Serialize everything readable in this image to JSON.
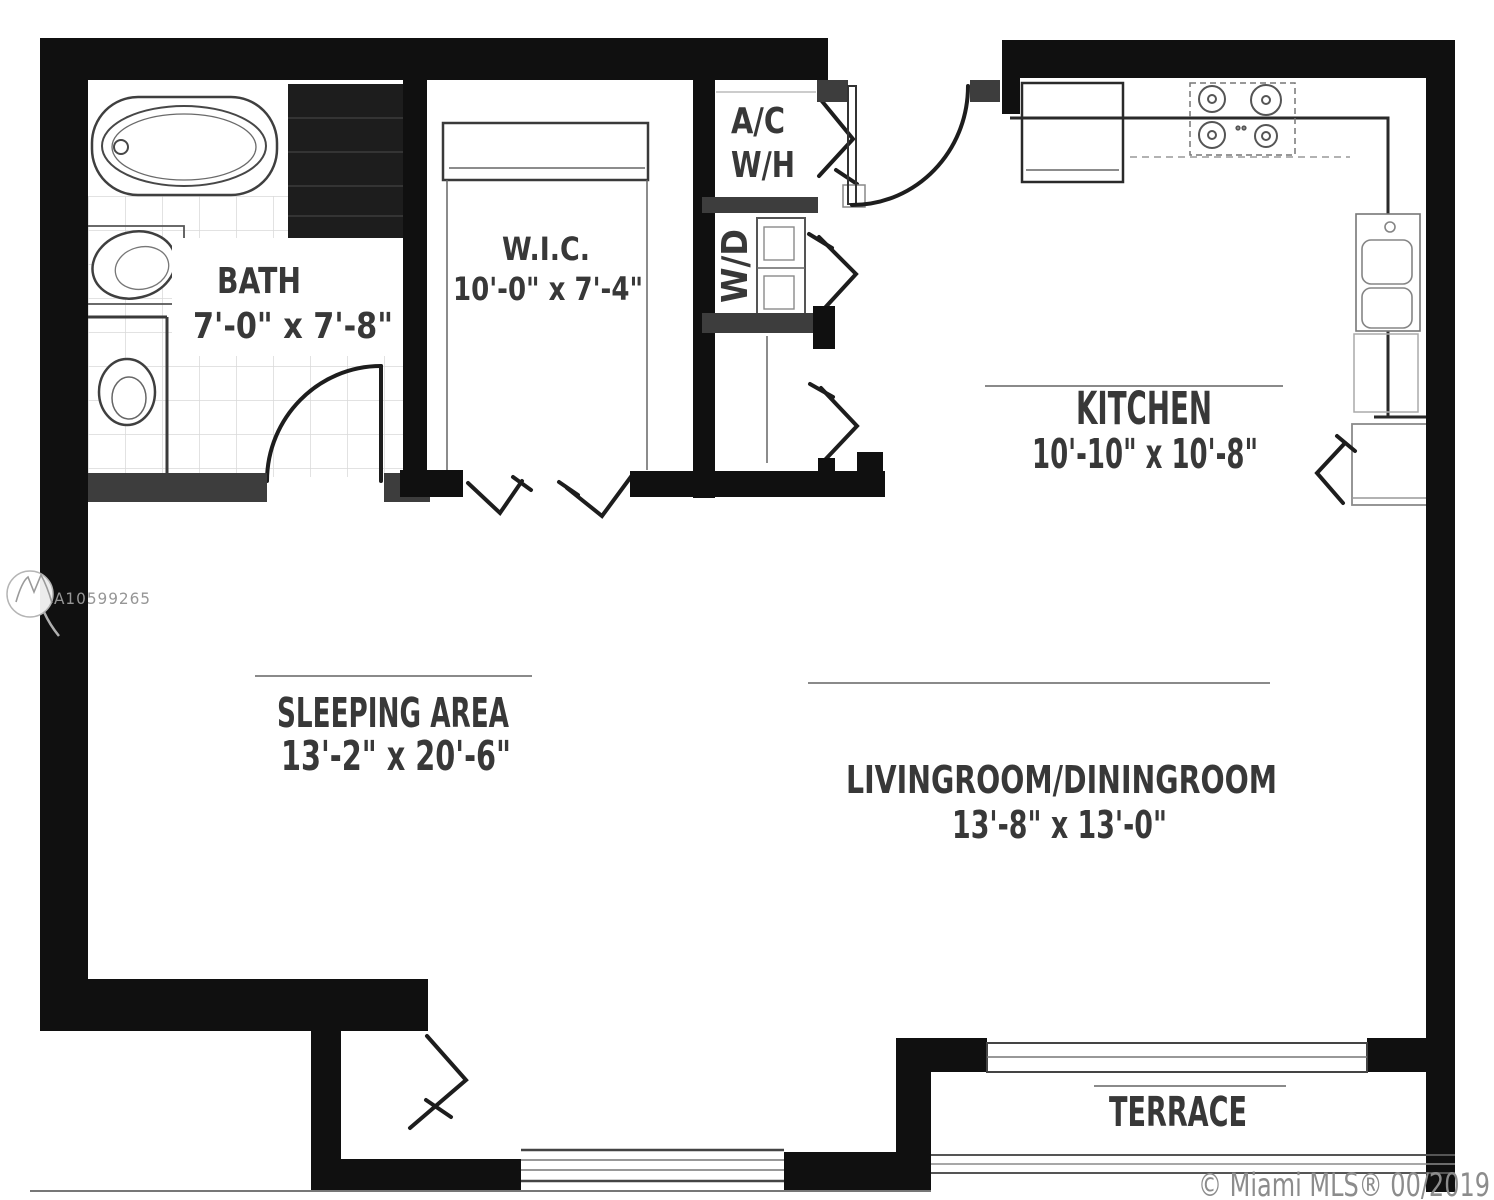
{
  "watermark": {
    "id": "A10599265",
    "logo": "mls-mountain-logo"
  },
  "credit": {
    "text": "© Miami MLS® 00/2019"
  },
  "rooms": {
    "bath": {
      "label": "BATH",
      "dims": "7'-0\" x 7'-8\""
    },
    "wic": {
      "label": "W.I.C.",
      "dims": "10'-0\" x 7'-4\""
    },
    "ac_wh": {
      "label_line1": "A/C",
      "label_line2": "W/H"
    },
    "wd": {
      "label": "W/D"
    },
    "kitchen": {
      "label": "KITCHEN",
      "dims": "10'-10\" x 10'-8\""
    },
    "sleeping": {
      "label": "SLEEPING AREA",
      "dims": "13'-2\" x 20'-6\""
    },
    "living": {
      "label": "LIVINGROOM/DININGROOM",
      "dims": "13'-8\" x 13'-0\""
    },
    "terrace": {
      "label": "TERRACE"
    }
  },
  "colors": {
    "wall": "#101010",
    "interior_wall": "#3d3d3d",
    "text": "#383838",
    "faint_line": "#8c8c8c",
    "watermark": "#969696"
  }
}
